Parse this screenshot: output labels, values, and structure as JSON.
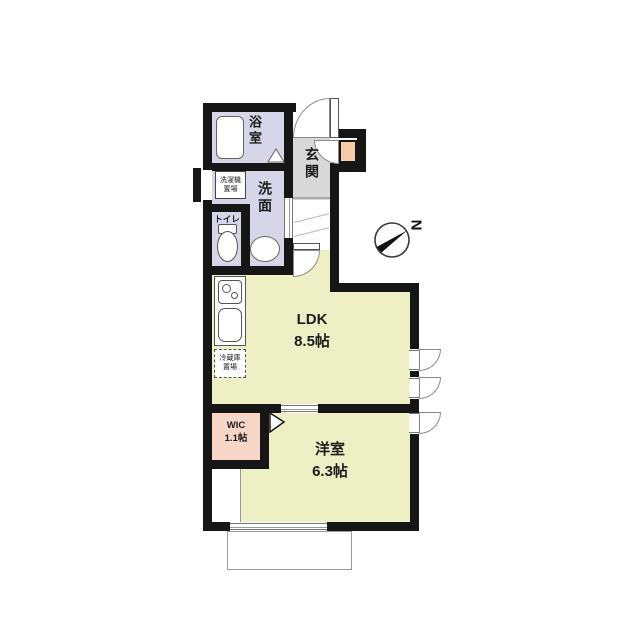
{
  "floorplan": {
    "compass": {
      "north_label": "N"
    },
    "rooms": {
      "bathroom": {
        "label": "浴室"
      },
      "washroom": {
        "label": "洗面"
      },
      "toilet": {
        "label": "トイレ"
      },
      "entrance": {
        "label": "玄関"
      },
      "ldk": {
        "name": "LDK",
        "area": "8.5帖"
      },
      "wic": {
        "name": "WIC",
        "area": "1.1帖"
      },
      "western_room": {
        "name": "洋室",
        "area": "6.3帖"
      }
    },
    "fixtures": {
      "washing_machine": {
        "line1": "洗濯機",
        "line2": "置場"
      },
      "refrigerator": {
        "line1": "冷蔵庫",
        "line2": "置場"
      }
    },
    "colors": {
      "wall": "#161616",
      "wet_area_floor": "#d6d6e8",
      "entrance_tile": "#d8d8d8",
      "living_floor": "#edf0c5",
      "wic_floor": "#f7d5c7",
      "shoe_cabinet": "#f8cca9"
    }
  }
}
